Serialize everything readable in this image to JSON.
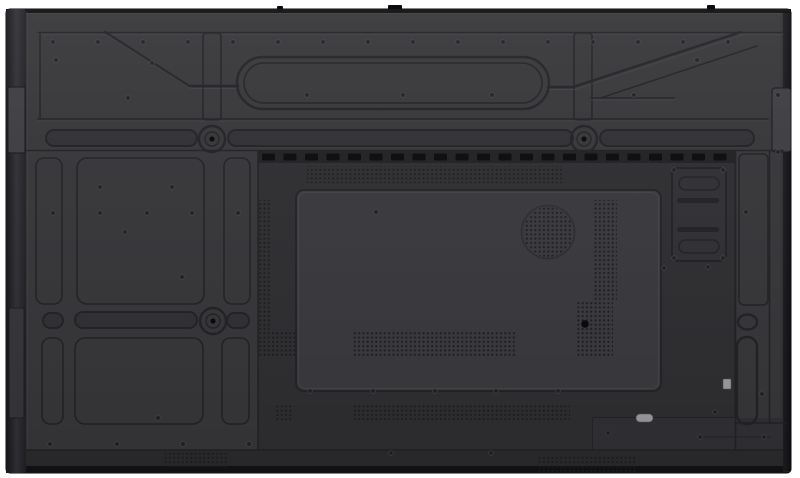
{
  "meta": {
    "type": "product-photo",
    "description": "Rear view of a large flat-panel display: dark grey plastic back housing with embossed ribs, recessed handle slots, vent perforations, speaker grille and port cover plate. No visible text.",
    "background": "#ffffff"
  },
  "palette": {
    "white": "#ffffff",
    "device_edge": "#141417",
    "bezel_dark": "#232327",
    "plate": "#37373a",
    "plate_dark": "#313135",
    "groove": "#232327",
    "highlight": "#55555c",
    "panel_recess": "#2f2f32",
    "inner_panel": "#3a3a3e",
    "vent_strip": "#222225",
    "vent_dash": "#0c0c0e",
    "perf_dot": "#1d1d20",
    "bottom_strip": "#2b2b2e",
    "bottom_edge": "#131316",
    "tab": "#3e3e42",
    "light_part": "#9c9ca0",
    "screw_fill": "#222226",
    "screw_rim": "#4b4b50",
    "black_screw": "#0a0a0b"
  },
  "features": {
    "vents_top": {
      "x": 262,
      "y": 153.5,
      "dash_w": 13,
      "dash_h": 7,
      "step": 21.5,
      "count": 22
    },
    "perf_areas": [
      {
        "name": "top-vent-perforation",
        "x": 307,
        "y": 166,
        "w": 255,
        "h": 17
      },
      {
        "name": "left-perforation-column",
        "x": 258,
        "y": 200,
        "w": 14,
        "h": 130
      },
      {
        "name": "left-perforation-block",
        "x": 258,
        "y": 330,
        "w": 38,
        "h": 27
      },
      {
        "name": "right-perforation-column",
        "x": 593,
        "y": 200,
        "w": 24,
        "h": 100
      },
      {
        "name": "right-perforation-block",
        "x": 576,
        "y": 300,
        "w": 37,
        "h": 57
      },
      {
        "name": "inner-panel-perforation",
        "x": 352,
        "y": 332,
        "w": 165,
        "h": 25
      },
      {
        "name": "small-perforation-patch",
        "x": 276,
        "y": 403,
        "w": 16,
        "h": 18
      },
      {
        "name": "lower-perforation-band",
        "x": 352,
        "y": 403,
        "w": 218,
        "h": 17
      },
      {
        "name": "bottom-strip-perforation-left",
        "x": 162,
        "y": 453,
        "w": 66,
        "h": 15
      },
      {
        "name": "bottom-strip-perforation-right",
        "x": 538,
        "y": 455,
        "w": 98,
        "h": 17
      }
    ],
    "handle_slots": [
      {
        "x": 46,
        "y": 130,
        "w": 151,
        "h": 16
      },
      {
        "x": 228,
        "y": 130,
        "w": 345,
        "h": 16
      },
      {
        "x": 600,
        "y": 130,
        "w": 154,
        "h": 16
      },
      {
        "x": 43,
        "y": 313,
        "w": 20,
        "h": 15
      },
      {
        "x": 75,
        "y": 312,
        "w": 122,
        "h": 16
      },
      {
        "x": 227,
        "y": 313,
        "w": 22,
        "h": 15
      }
    ],
    "screw_bosses": [
      [
        212,
        139
      ],
      [
        584,
        139
      ],
      [
        213,
        321
      ]
    ],
    "speaker": {
      "cx": 548,
      "cy": 232,
      "r": 25
    },
    "port_plate": {
      "x": 672,
      "y": 168,
      "w": 54,
      "h": 93,
      "pill_slots": [
        [
          679,
          177,
          40,
          13
        ],
        [
          679,
          240,
          40,
          13
        ]
      ],
      "groove_slots": [
        [
          677,
          198,
          42,
          5
        ],
        [
          677,
          227,
          42,
          5
        ]
      ]
    },
    "screws": [
      [
        53,
        42
      ],
      [
        98,
        42
      ],
      [
        143,
        42
      ],
      [
        188,
        42
      ],
      [
        233,
        42
      ],
      [
        278,
        42
      ],
      [
        323,
        42
      ],
      [
        368,
        42
      ],
      [
        413,
        42
      ],
      [
        458,
        42
      ],
      [
        503,
        42
      ],
      [
        548,
        42
      ],
      [
        593,
        42
      ],
      [
        638,
        42
      ],
      [
        683,
        42
      ],
      [
        728,
        42
      ],
      [
        56,
        60
      ],
      [
        152,
        63
      ],
      [
        128,
        98
      ],
      [
        307,
        95
      ],
      [
        403,
        95
      ],
      [
        492,
        95
      ],
      [
        634,
        95
      ],
      [
        697,
        60
      ],
      [
        53,
        213
      ],
      [
        100,
        213
      ],
      [
        147,
        213
      ],
      [
        192,
        213
      ],
      [
        238,
        213
      ],
      [
        100,
        187
      ],
      [
        172,
        187
      ],
      [
        125,
        232
      ],
      [
        182,
        277
      ],
      [
        376,
        212
      ],
      [
        158,
        418
      ],
      [
        310,
        391
      ],
      [
        373,
        391
      ],
      [
        435,
        391
      ],
      [
        496,
        391
      ],
      [
        558,
        391
      ],
      [
        50,
        444
      ],
      [
        117,
        444
      ],
      [
        183,
        444
      ],
      [
        249,
        444
      ],
      [
        391,
        453
      ],
      [
        491,
        453
      ],
      [
        674,
        170
      ],
      [
        723,
        170
      ],
      [
        674,
        258
      ],
      [
        723,
        258
      ],
      [
        664,
        268
      ],
      [
        708,
        267
      ],
      [
        746,
        212
      ],
      [
        762,
        394
      ],
      [
        715,
        412
      ],
      [
        608,
        433
      ],
      [
        700,
        437
      ],
      [
        764,
        437
      ],
      [
        778,
        95
      ],
      [
        778,
        152
      ]
    ],
    "black_screws": [
      [
        585,
        324
      ]
    ],
    "top_rim_marks": [
      [
        277,
        6,
        6,
        5
      ],
      [
        388,
        5,
        14,
        6
      ],
      [
        707,
        5,
        8,
        6
      ]
    ],
    "light_parts": [
      {
        "name": "small-connector",
        "x": 723,
        "y": 379,
        "w": 8,
        "h": 10,
        "rx": 1
      },
      {
        "name": "oval-label",
        "x": 636,
        "y": 414,
        "w": 17,
        "h": 8,
        "rx": 4
      }
    ]
  }
}
